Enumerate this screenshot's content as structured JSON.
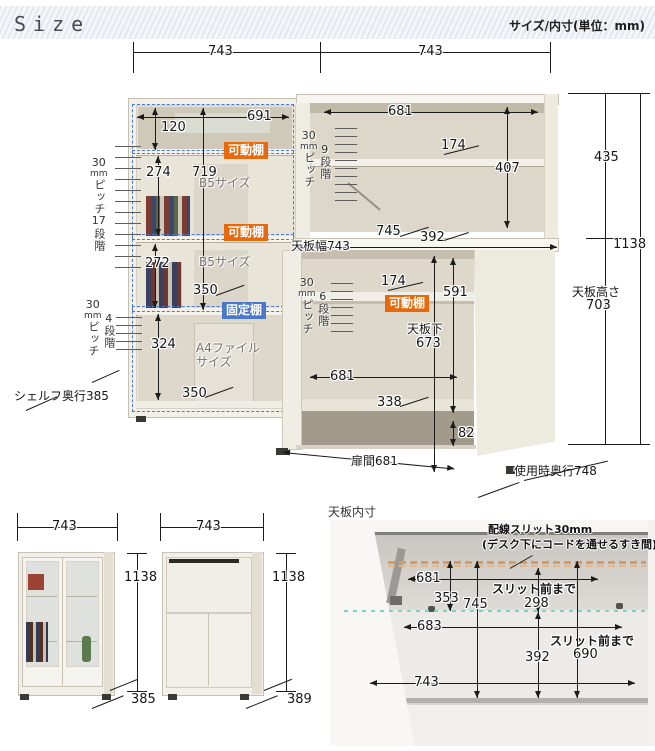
{
  "header": {
    "title": "Size",
    "unit_note": "サイズ/内寸(単位：mm)"
  },
  "badges": {
    "movable": "可動棚",
    "fixed": "固定棚"
  },
  "colors": {
    "accent_orange": "#e8690b",
    "accent_blue": "#4a77c9",
    "dash_blue": "#4a79d2",
    "slit_orange": "#dc9a5e",
    "teal_dots": "#7fd1c6"
  },
  "main": {
    "top_width_left": "743",
    "top_width_right": "743",
    "left_unit": {
      "inner_width": "691",
      "top_gap": "120",
      "shelf_span": "274",
      "inner_height": "719",
      "b5_top": "B5サイズ",
      "mid_span": "272",
      "b5_mid": "B5サイズ",
      "depth_mid": "350",
      "bottom_span": "324",
      "a4_line1": "A4ファイル",
      "a4_line2": "サイズ",
      "depth_bottom": "350",
      "pitch17": {
        "num": "30",
        "unit": "mm",
        "pitch": "ピッチ",
        "steps": "17",
        "dan": "段階"
      },
      "pitch4": {
        "num": "30",
        "unit": "mm",
        "pitch": "ピッチ",
        "steps": "4",
        "dan": "段階"
      },
      "shelf_depth": "シェルフ奥行385"
    },
    "hutch": {
      "inner_width": "681",
      "pitch9": {
        "num": "30",
        "unit": "mm",
        "pitch": "ピッチ",
        "steps": "9",
        "dan": "段階"
      },
      "shelf_depth": "174",
      "inner_height": "407",
      "top_width": "天板幅743",
      "desk_depth": "745",
      "desk_clear": "392"
    },
    "under_desk": {
      "pitch6": {
        "num": "30",
        "unit": "mm",
        "pitch": "ピッチ",
        "steps": "6",
        "dan": "段階"
      },
      "shelf_depth": "174",
      "inner_height": "591",
      "under_label_1": "天板下",
      "under_label_2": "673",
      "inner_width": "681",
      "floor_depth": "338",
      "base_gap": "82",
      "door_gap": "扉間681"
    },
    "right_dims": {
      "upper": "435",
      "total": "1138",
      "desk_height_label": "天板高さ",
      "desk_height": "703",
      "use_depth": "使用時奥行748"
    }
  },
  "bottom_left": {
    "cab1": {
      "width": "743",
      "height": "1138",
      "depth": "385"
    },
    "cab2": {
      "width": "743",
      "height": "1138",
      "depth": "389"
    }
  },
  "bottom_right": {
    "title": "天板内寸",
    "note1": "配線スリット30mm",
    "note2": "(デスク下にコードを通せるすき間)",
    "slit_width": "681",
    "slit_to_back": "353",
    "top_depth": "745",
    "slit_front_label": "スリット前まで",
    "slit_front_upper": "298",
    "lower_width": "683",
    "slit_front_label2": "スリット前まで",
    "slit_front_lower": "690",
    "front_depth": "392",
    "top_width": "743"
  }
}
